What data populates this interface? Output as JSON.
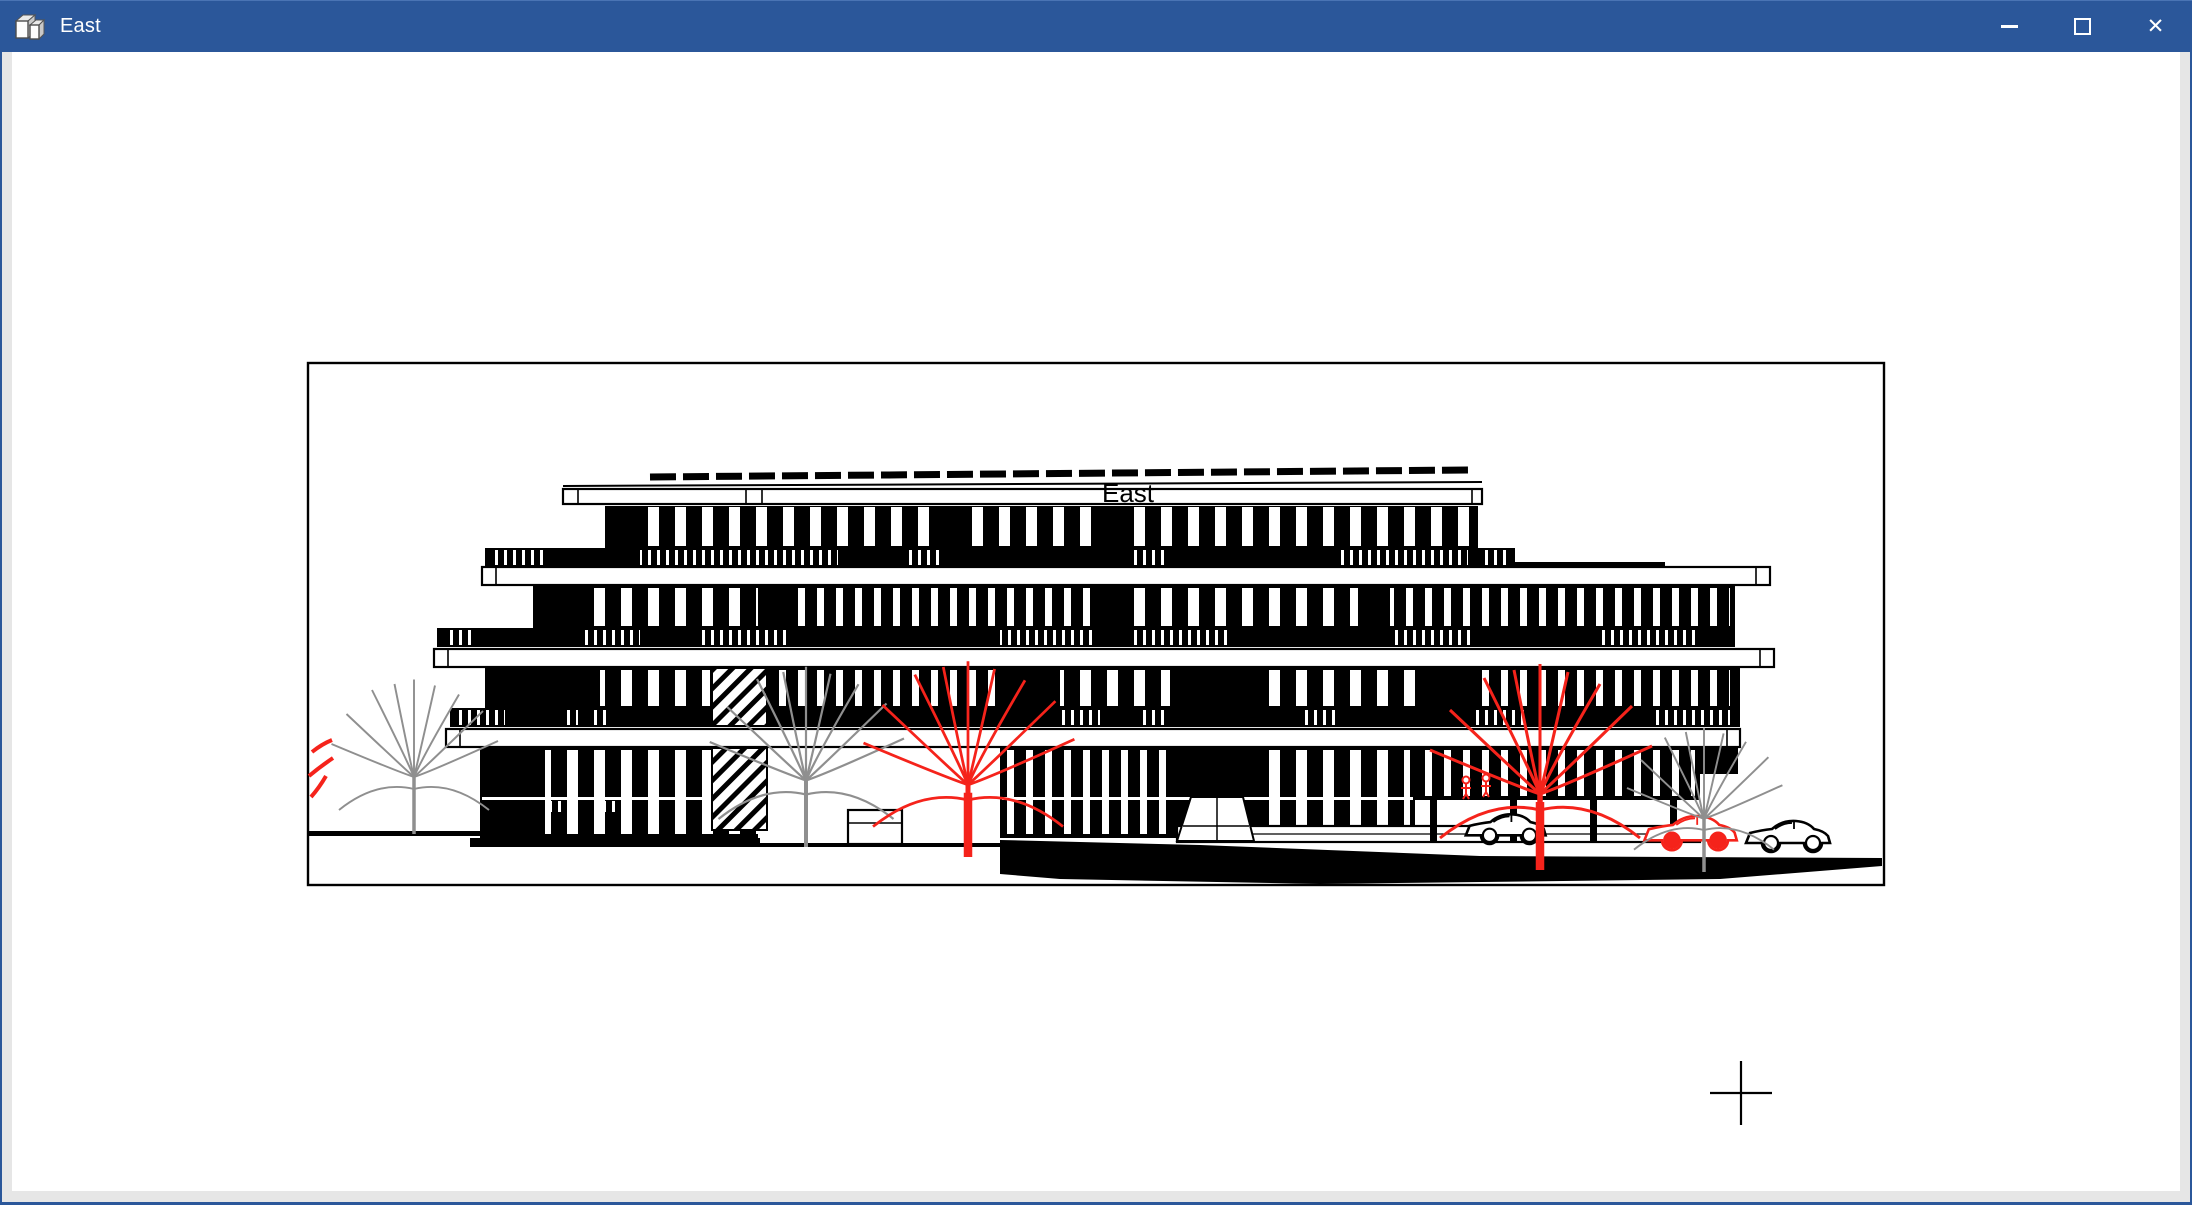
{
  "window": {
    "title": "East",
    "app_icon": "elevation-view-3d-icon",
    "controls": [
      {
        "name": "minimize",
        "icon": "minimize-icon",
        "glyph": "–"
      },
      {
        "name": "maximize",
        "icon": "maximize-icon",
        "glyph": "□"
      },
      {
        "name": "close",
        "icon": "close-icon",
        "glyph": "✕"
      }
    ]
  },
  "drawing": {
    "view_label": "East",
    "type": "building-elevation",
    "cursor": {
      "style": "crosshair",
      "x": 1741,
      "y": 1093
    }
  },
  "colors": {
    "titlebar_blue": "#2b579a",
    "frame_blue": "#2b579a",
    "frame_gray": "#e6e6e6",
    "canvas_white": "#ffffff",
    "drawing_black": "#000000",
    "annotation_red": "#f5231b",
    "tree_gray": "#8f8f8f"
  }
}
